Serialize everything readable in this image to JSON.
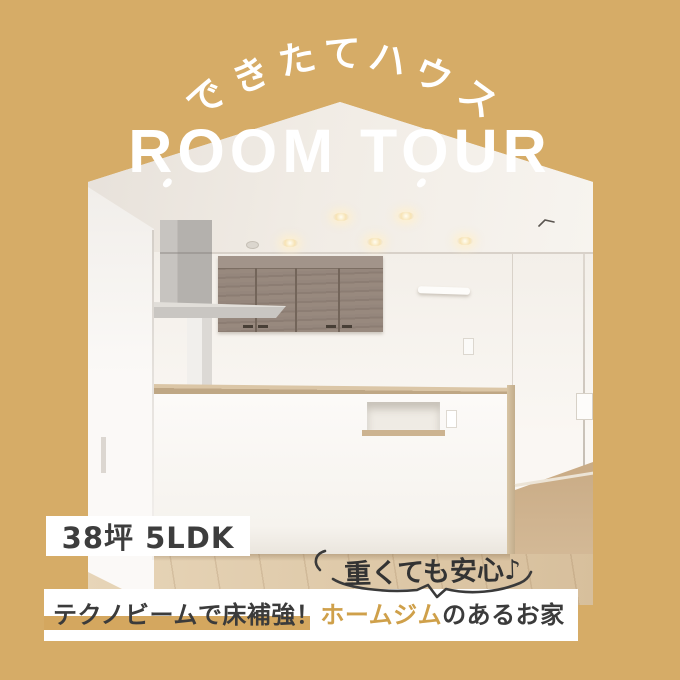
{
  "colors": {
    "background": "#d6ac67",
    "title_text": "#ffffff",
    "dark_text": "#3b3b3b",
    "caption_highlight_text": "#cfa04a",
    "caption_underline": "#d4a75f"
  },
  "header": {
    "arc_label": "できたてハウス",
    "title": "ROOM TOUR"
  },
  "badge": {
    "floor_area": "38坪 5LDK"
  },
  "callout": {
    "text": "重くても安心♪"
  },
  "caption": {
    "pre": "テクノビームで床補強！",
    "highlight": "ホームジム",
    "post": "のあるお家"
  }
}
